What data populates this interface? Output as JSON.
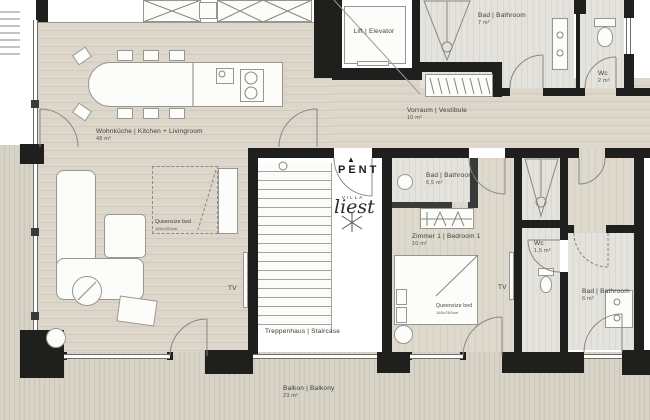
{
  "plan": {
    "pent": "PENT",
    "logo": {
      "top": "VILLA",
      "script": "liest"
    },
    "icons": {
      "pent_arrow": "▲"
    },
    "rooms": [
      {
        "name": "Wohnküche | Kitchen + Livingroom",
        "area": "48 m²"
      },
      {
        "name": "Lift | Elevator",
        "area": ""
      },
      {
        "name": "Bad | Bathroom",
        "area": "7 m²"
      },
      {
        "name": "Wc",
        "area": "2 m²"
      },
      {
        "name": "Vorraum | Vestibule",
        "area": "10 m²"
      },
      {
        "name": "Bad | Bathroom",
        "area": "6,5 m²"
      },
      {
        "name": "Zimmer 1 | Bedroom 1",
        "area": "10 m²"
      },
      {
        "name": "Wc",
        "area": "1,5 m²"
      },
      {
        "name": "Bad | Bathroom",
        "area": "6 m²"
      },
      {
        "name": "Treppenhaus | Staircase",
        "area": ""
      },
      {
        "name": "Balkon | Balkony",
        "area": "23 m²"
      }
    ],
    "annotations": {
      "tv": "TV",
      "queensize_bed": "Queensize bed",
      "bed_size": "180x200cm"
    },
    "colors": {
      "wall": "#1f1f1e",
      "floor_wood": "#dcd7ca",
      "floor_tile": "#e4e2dd",
      "balcony_deck": "#d7d3c7"
    }
  }
}
